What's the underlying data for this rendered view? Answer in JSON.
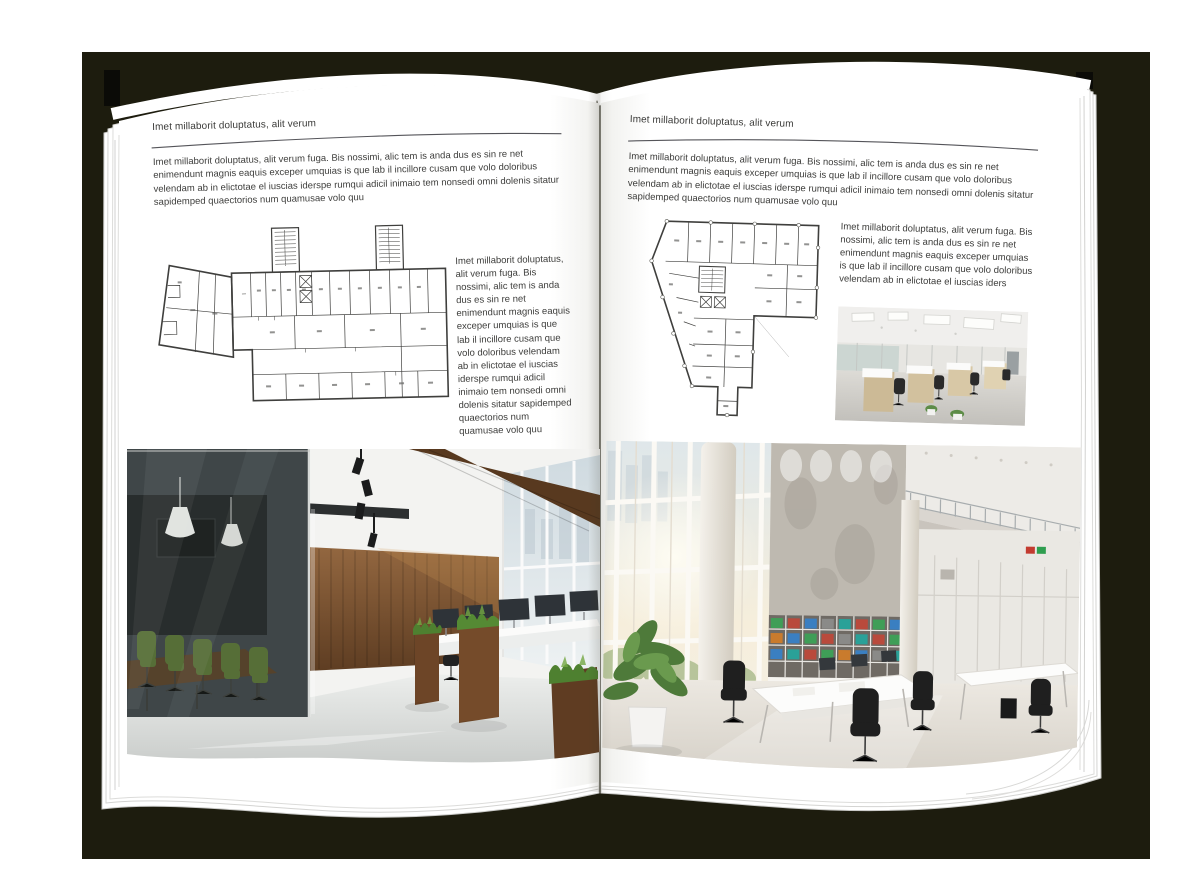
{
  "palette": {
    "backdrop": "#1d1c0e",
    "page": "#ffffff",
    "text": "#3c3c3a",
    "rule_line": "#55555a",
    "plan_line": "#3f3f3d",
    "wood": "#7a5533",
    "plant_green": "#5f8f3a",
    "glass_tint": "#9fb3a6",
    "floor_gray": "#d9dad8"
  },
  "left_page": {
    "header": "Imet millaborit doluptatus, alit verum",
    "intro": "Imet millaborit doluptatus, alit verum fuga. Bis nossimi, alic tem is anda dus es sin re net enimendunt magnis eaquis exceper umquias is que lab il incillore cusam que volo doloribus velendam ab in elictotae el iuscias iderspe rumqui adicil inimaio tem nonsedi omni dolenis sitatur sapidemped quaectorios num quamusae volo quu",
    "side_text": "Imet millaborit doluptatus, alit verum fuga. Bis nossimi, alic tem is anda dus es sin re net enimendunt magnis eaquis exceper umquias is que lab il incillore cusam que volo doloribus velendam ab in elictotae el iuscias iderspe rumqui adicil inimaio tem nonsedi omni dolenis sitatur sapidemped quaectorios num quamusae volo quu",
    "floorplan_label": "building-floor-plan-drawing",
    "photo_label": "loft-office-interior-photo"
  },
  "right_page": {
    "header": "Imet millaborit doluptatus, alit verum",
    "intro": "Imet millaborit doluptatus, alit verum fuga. Bis nossimi, alic tem is anda dus es sin re net enimendunt magnis eaquis exceper umquias is que lab il incillore cusam que volo doloribus velendam ab in elictotae el iuscias iderspe rumqui adicil inimaio tem nonsedi omni dolenis sitatur sapidemped quaectorios num quamusae volo quu",
    "side_text": "Imet millaborit doluptatus, alit verum fuga. Bis nossimi, alic tem is anda dus es sin re net enimendunt magnis eaquis exceper umquias is que lab il incillore cusam que volo doloribus velendam ab in elictotae el iuscias iders",
    "floorplan_label": "building-floor-plan-drawing",
    "photo_small_label": "open-plan-workstations-photo",
    "photo_label": "bright-atrium-office-photo"
  }
}
